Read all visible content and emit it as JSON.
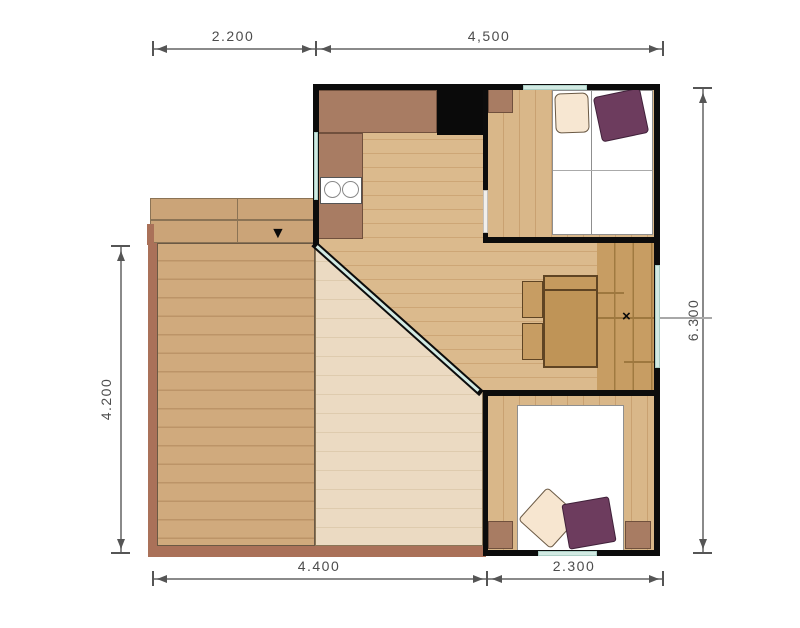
{
  "dimensions": {
    "top": [
      {
        "label": "2.200"
      },
      {
        "label": "4,500"
      }
    ],
    "bottom": [
      {
        "label": "4.400"
      },
      {
        "label": "2.300"
      }
    ],
    "left": {
      "label": "4.200"
    },
    "right": {
      "label": "6.300"
    }
  },
  "markers": {
    "entry_arrow": "▼",
    "door_cross": "×"
  },
  "colors": {
    "wall": "#0c0c0c",
    "interior_wood": "#dbba8d",
    "deck_wood": "#d0aa7d",
    "deck_washed": "#ebdac2",
    "parquet_dark": "#c79d63",
    "counter_brown": "#a87c63",
    "glass_window": "#d2eae3",
    "deck_frame": "#aa7159",
    "pillow_purple": "#6d3c5e",
    "pillow_cream": "#f7e7d2",
    "dimension_gray": "#555555"
  }
}
